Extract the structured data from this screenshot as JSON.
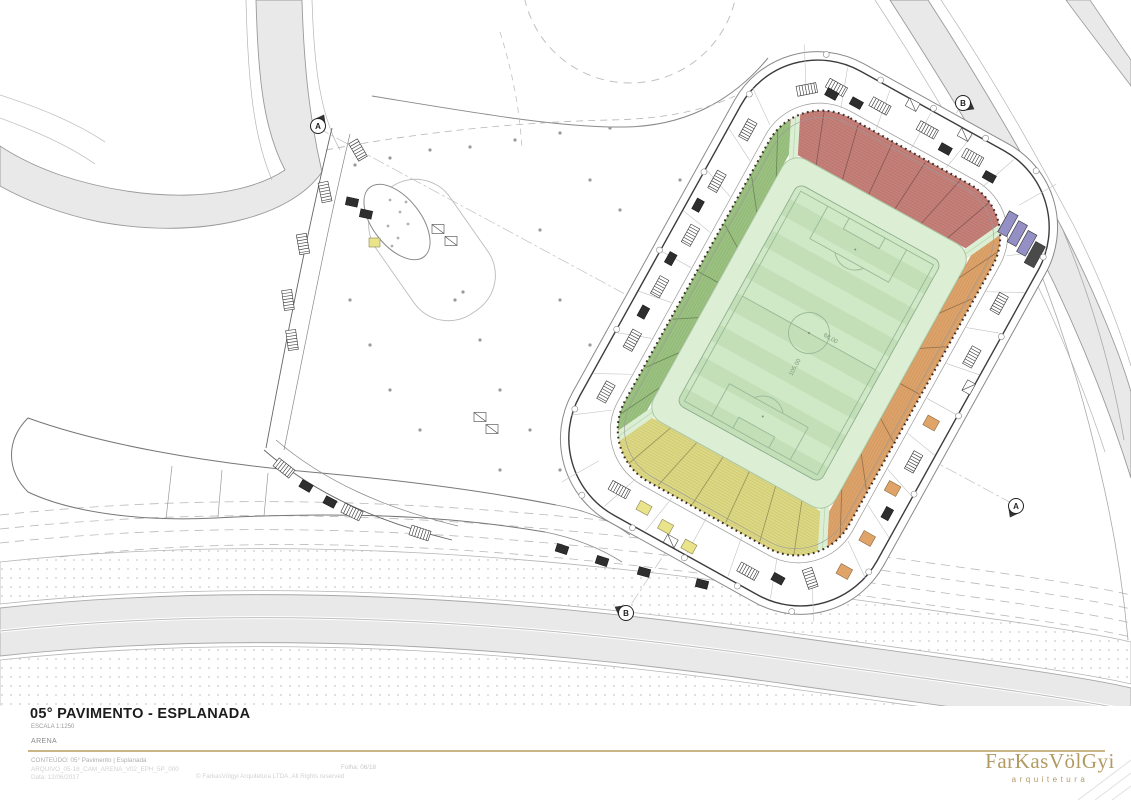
{
  "document": {
    "title": "05° PAVIMENTO - ESPLANADA",
    "scale": "ESCALA 1:1250",
    "project": "ARENA",
    "content_line": "CONTEÚDO: 05° Pavimento | Esplanada",
    "file_line": "ARQUIVO_05-18_CAM_ARENA_V02_EPH_5P_000",
    "date_line": "Data: 12/06/2017",
    "sheet_line": "Folha: 06/18",
    "copyright_line": "© FarkasVölgyi Arquitetura LTDA. All Rights reserved",
    "logo": {
      "wordmark": "FarKasVölGyi",
      "tagline": "arquitetura",
      "color": "#b29a63"
    }
  },
  "plan": {
    "section_markers": [
      {
        "label": "A"
      },
      {
        "label": "B"
      },
      {
        "label": "A"
      },
      {
        "label": "B"
      }
    ],
    "stands": {
      "west": {
        "name": "arquibancada-oeste",
        "color": "#9cc282"
      },
      "north": {
        "name": "arquibancada-norte",
        "color": "#c5807a"
      },
      "east": {
        "name": "arquibancada-leste",
        "color": "#dda36b"
      },
      "south": {
        "name": "arquibancada-sul",
        "color": "#ddd884"
      }
    },
    "pitch": {
      "base": "#cfe8c6",
      "stripe": "#c2dfb8",
      "apron": "#dcefd4",
      "line": "#98b898",
      "dim_length": "105,00",
      "dim_width": "68,00"
    },
    "accents": {
      "vip": "#9490c5",
      "kiosk_yellow": "#e9e48a",
      "kiosk_orange": "#e0a368",
      "road_fill": "#e9e9e9"
    }
  }
}
